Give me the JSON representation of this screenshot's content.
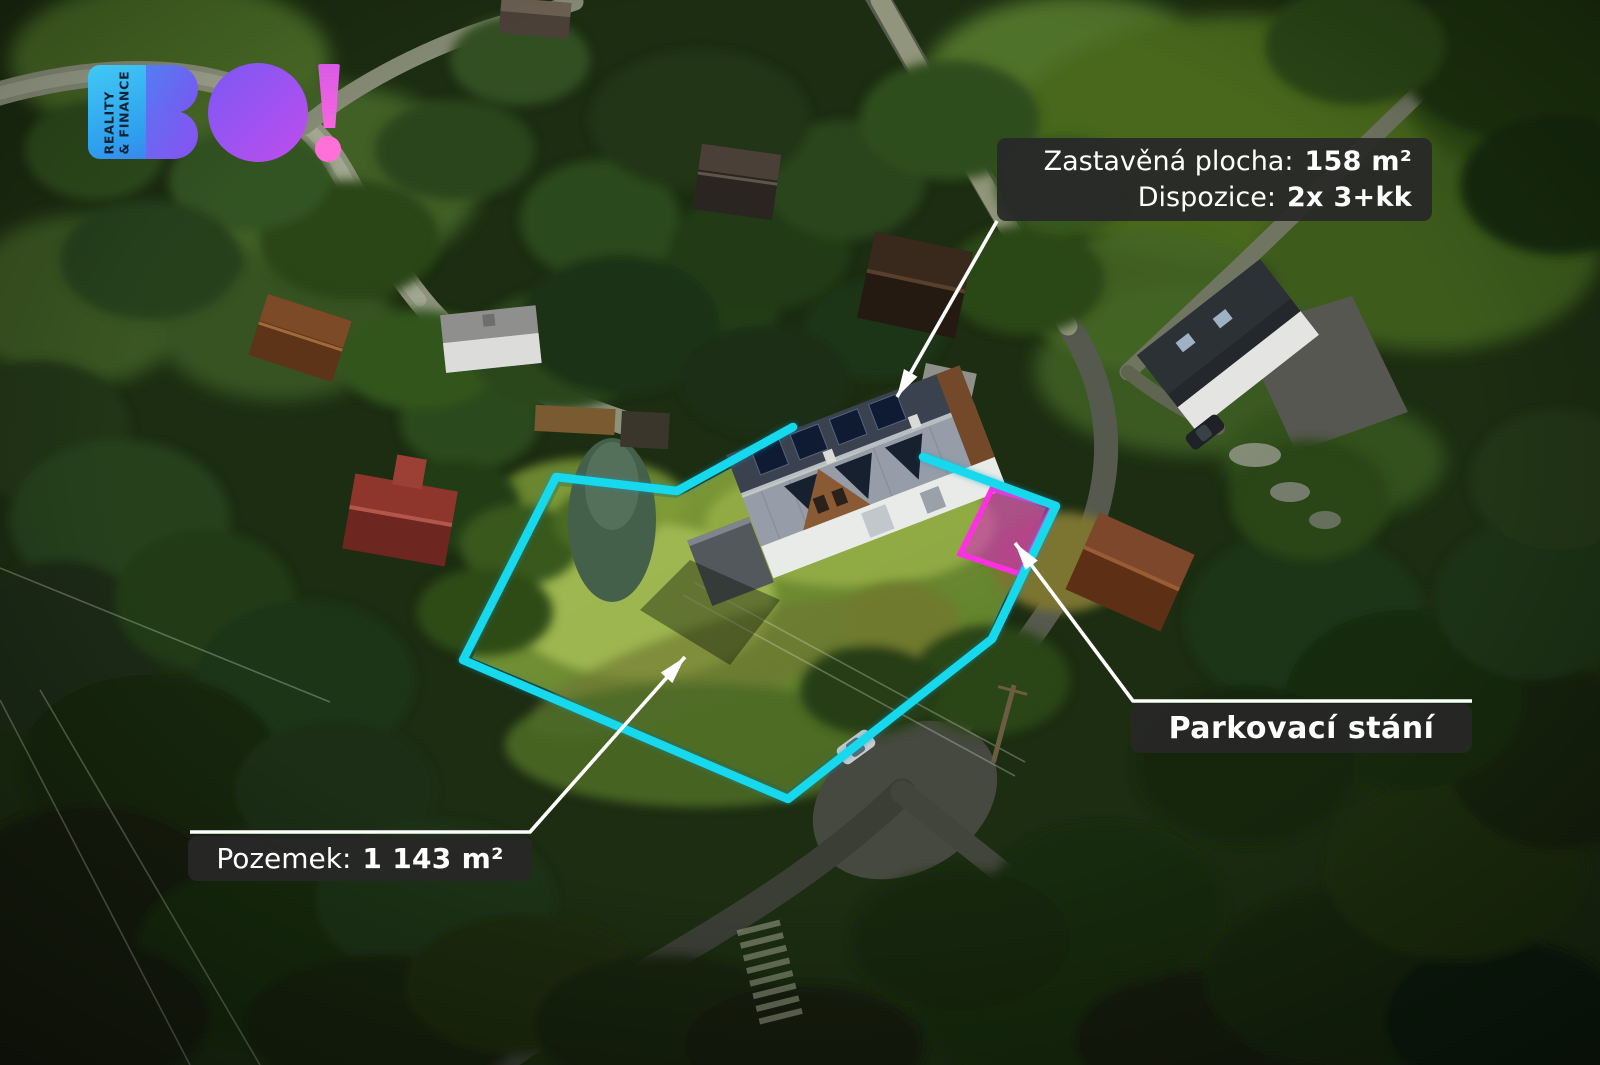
{
  "brand": {
    "name": "BO!",
    "tagline": [
      "REALITY",
      "& FINANCE"
    ]
  },
  "annotations": {
    "built_area": {
      "label": "Zastavěná plocha:",
      "value": "158 m²"
    },
    "disposition": {
      "label": "Dispozice:",
      "value": "2x 3+kk"
    },
    "plot": {
      "label": "Pozemek:",
      "value": "1 143 m²"
    },
    "parking": {
      "label": "Parkovací stání"
    }
  },
  "colors": {
    "boundary": "#17d9ee",
    "parking_fill": "#e61ad6",
    "parking_stroke": "#ff2fe3",
    "leader_line": "#ffffff",
    "label_background": "#282828",
    "label_text": "#ffffff"
  }
}
